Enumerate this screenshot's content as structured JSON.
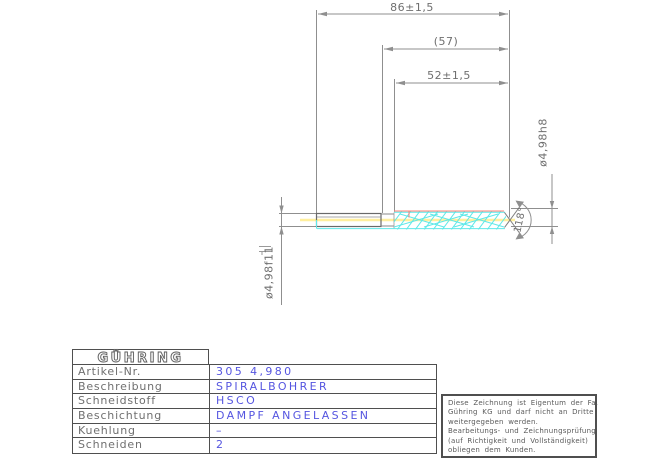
{
  "drawing": {
    "dimensions": {
      "overall_length": "86±1,5",
      "reference_length": "(57)",
      "flute_length": "52±1,5",
      "shank_diameter": "ø4,98f11",
      "cutting_diameter": "ø4,98h8",
      "point_angle": "118°"
    },
    "colors": {
      "line_gray": "#8a8a8a",
      "part_gray": "#696969",
      "flute_cyan": "#5fe8e8",
      "centerline_yellow": "#ffef9e",
      "margin_red": "#ff8076",
      "value_blue": "#5555e0"
    }
  },
  "title_block": {
    "logo_text": "GÜHRING",
    "rows": [
      {
        "label": "Artikel-Nr.",
        "value": "305  4,980"
      },
      {
        "label": "Beschreibung",
        "value": "SPIRALBOHRER"
      },
      {
        "label": "Schneidstoff",
        "value": "HSCO"
      },
      {
        "label": "Beschichtung",
        "value": "DAMPF  ANGELASSEN"
      },
      {
        "label": "Kuehlung",
        "value": "–"
      },
      {
        "label": "Schneiden",
        "value": "2"
      }
    ]
  },
  "note_box": {
    "lines": [
      "Diese Zeichnung ist Eigentum der Fa.",
      "Gühring KG und darf nicht an Dritte",
      "weitergegeben werden.",
      "Bearbeitungs- und Zeichnungsprüfung",
      "(auf Richtigkeit und Vollständigkeit)",
      "obliegen dem Kunden."
    ]
  }
}
